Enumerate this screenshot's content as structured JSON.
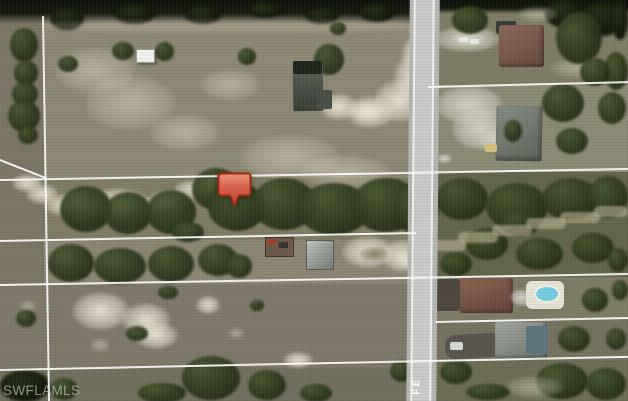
{
  "watermark": {
    "text": "SWFLAMLS"
  },
  "road": {
    "label": "FE"
  },
  "marker": {
    "icon": "map-pin-icon"
  },
  "colors": {
    "marker_fill": "#d5604a",
    "marker_border": "#9e2b16",
    "road_surface": "#c9cbc8",
    "road_edge_line": "#f0f1ee",
    "lot_line": "#ffffff",
    "field_olive": "#87836e",
    "scrub_olive": "#636549",
    "tree_dark_green": "#2b3619",
    "sand": "#e0dac4",
    "pool_water": "#74cdde",
    "watermark_text": "#d0d6cf"
  }
}
